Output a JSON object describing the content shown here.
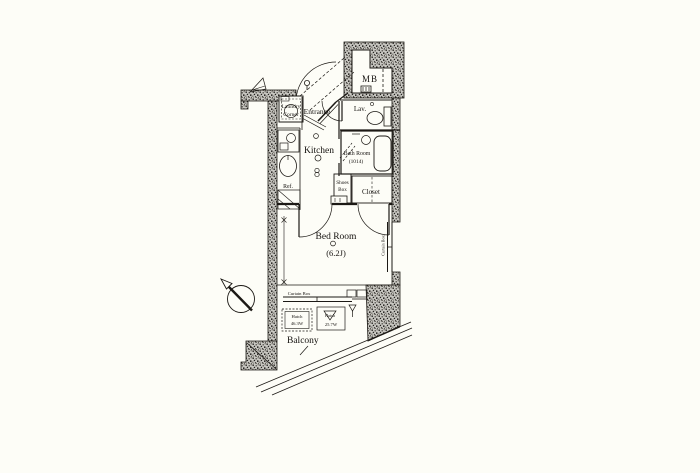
{
  "plan": {
    "rooms": {
      "entrance": "Entrance",
      "mb": "MB",
      "lav": "Lav.",
      "laundry_line1": "Laundry",
      "laundry_line2": "Corner",
      "kitchen": "Kitchen",
      "bath_line1": "Bath Room",
      "bath_line2": "(1014)",
      "shoes_line1": "Shoes",
      "shoes_line2": "Box",
      "closet": "Closet",
      "bedroom_line1": "Bed Room",
      "bedroom_line2": "(6.2J)",
      "balcony": "Balcony"
    },
    "fixtures": {
      "ref": "Ref.",
      "curtain_box_bottom": "Curtain Box",
      "curtain_box_right": "Curtain Box",
      "hatch_left_line1": "Hatch",
      "hatch_left_line2": "46.3W",
      "hatch_right_line1": "Hatch",
      "hatch_right_line2": "25.7W"
    },
    "colors": {
      "line": "#1c1915",
      "wall_fill_base": "#c9c8c2",
      "paper": "#fdfdf7"
    }
  }
}
